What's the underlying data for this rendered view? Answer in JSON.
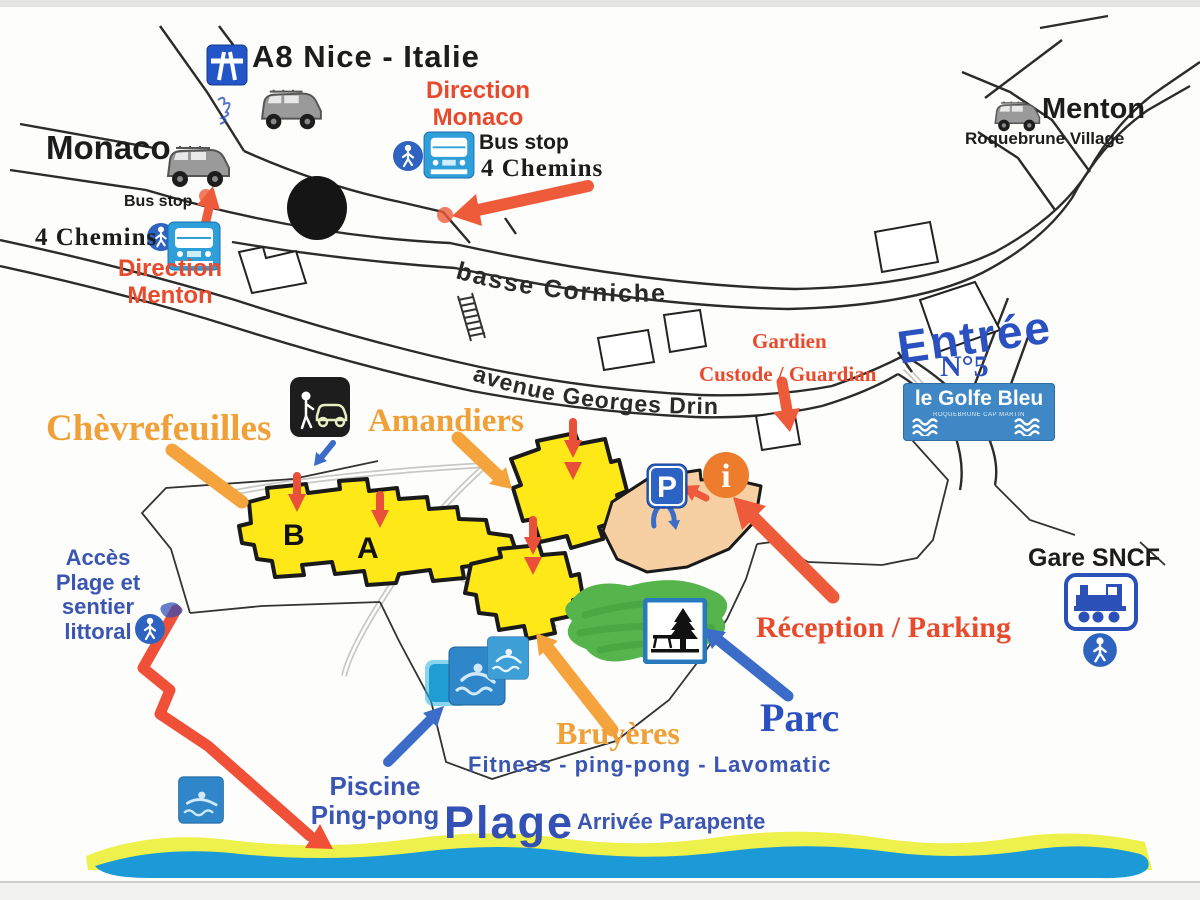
{
  "top": {
    "motorway_label": "A8 Nice - Italie",
    "monaco": "Monaco",
    "menton": "Menton",
    "roquebrune": "Roquebrune Village",
    "direction_monaco": [
      "Direction",
      "Monaco"
    ],
    "direction_menton": [
      "Direction",
      "Menton"
    ],
    "bus_stop_top": {
      "label": "Bus stop",
      "stop": "4 Chemins"
    },
    "bus_stop_left": {
      "label": "Bus stop",
      "stop": "4 Chemins"
    }
  },
  "roads": {
    "basse_corniche": "basse  Corniche",
    "avenue_georges_drin": "avenue  Georges Drin"
  },
  "guardian": {
    "title": "Gardien",
    "subtitle": "Custode / Guardian"
  },
  "entrance": {
    "entree": "Entrée",
    "number": "N°5",
    "sign_name": "le Golfe Bleu",
    "sign_subtitle": "ROQUEBRUNE CAP MARTIN"
  },
  "residences": {
    "chevrefeuilles": "Chèvrefeuilles",
    "amandiers": "Amandiers",
    "bruyeres": "Bruyères",
    "block_b": "B",
    "block_a": "A"
  },
  "facilities": {
    "reception": "Réception / Parking",
    "parc": "Parc",
    "fitness": "Fitness - ping-pong - Lavomatic",
    "piscine": [
      "Piscine",
      "Ping-pong"
    ],
    "gare": "Gare SNCF",
    "parking_sign": "P",
    "info_sign": "i"
  },
  "beach": {
    "access": [
      "Accès",
      "Plage et",
      "sentier",
      "littoral"
    ],
    "plage": "Plage",
    "parapente": "Arrivée Parapente"
  },
  "colors": {
    "red_label": "#e84a2e",
    "orange_label": "#f0a038",
    "blue_label": "#3a55b2",
    "entree_blue": "#2b50c0",
    "yellow_building": "#ffe817",
    "peach_building": "#f6cfa3",
    "parc_green": "#55b44b",
    "sea_blue": "#1b9ad7",
    "sand_yellow": "#eef04c",
    "sign_blue": "#2e9fd9",
    "arrow_red": "#ee5b3b",
    "arrow_orange": "#f5a33c",
    "arrow_blue": "#3a6cc8"
  }
}
